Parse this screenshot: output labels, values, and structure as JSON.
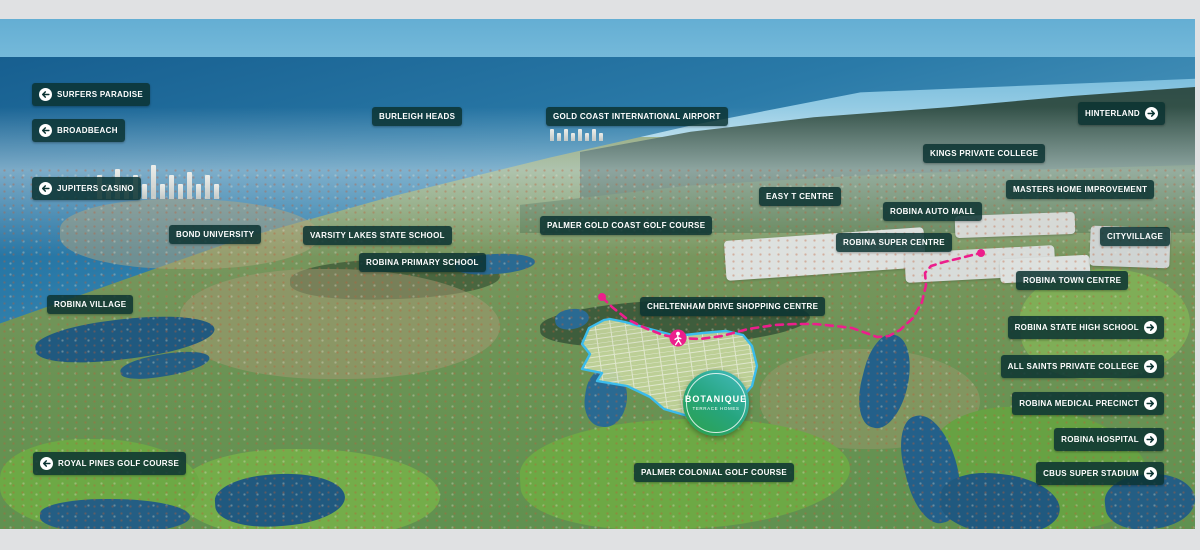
{
  "meta": {
    "title": "Botanique Robina aerial location map"
  },
  "colors": {
    "label_background": "#0a3231",
    "label_text": "#ffffff",
    "route_pink": "#ec1e8c",
    "boundary_cyan": "#3bbcec",
    "logo_gradient_start": "#46bcc2",
    "logo_gradient_end": "#2da148",
    "frame_grey": "#e0e1e3"
  },
  "logo": {
    "name": "BOTANIQUE",
    "tagline": "TERRACE HOMES"
  },
  "labels": [
    {
      "id": "surfers-paradise",
      "text": "SURFERS PARADISE",
      "x": 32,
      "y": 83,
      "arrow": "left"
    },
    {
      "id": "broadbeach",
      "text": "BROADBEACH",
      "x": 32,
      "y": 119,
      "arrow": "left"
    },
    {
      "id": "jupiters-casino",
      "text": "JUPITERS CASINO",
      "x": 32,
      "y": 177,
      "arrow": "left"
    },
    {
      "id": "burleigh-heads",
      "text": "BURLEIGH HEADS",
      "x": 372,
      "y": 107,
      "arrow": null
    },
    {
      "id": "gold-coast-international-airport",
      "text": "GOLD COAST INTERNATIONAL AIRPORT",
      "x": 546,
      "y": 107,
      "arrow": null
    },
    {
      "id": "hinterland",
      "text": "HINTERLAND",
      "right": 35,
      "y": 102,
      "arrow": "right"
    },
    {
      "id": "kings-private-college",
      "text": "KINGS PRIVATE COLLEGE",
      "x": 923,
      "y": 144,
      "arrow": null
    },
    {
      "id": "masters-home-improvement",
      "text": "MASTERS HOME IMPROVEMENT",
      "x": 1006,
      "y": 180,
      "arrow": null
    },
    {
      "id": "easy-t-centre",
      "text": "EASY T CENTRE",
      "x": 759,
      "y": 187,
      "arrow": null
    },
    {
      "id": "robina-auto-mall",
      "text": "ROBINA AUTO MALL",
      "x": 883,
      "y": 202,
      "arrow": null
    },
    {
      "id": "palmer-gold-coast-golf-course",
      "text": "PALMER GOLD COAST GOLF COURSE",
      "x": 540,
      "y": 216,
      "arrow": null
    },
    {
      "id": "bond-university",
      "text": "BOND UNIVERSITY",
      "x": 169,
      "y": 225,
      "arrow": null
    },
    {
      "id": "varsity-lakes-state-school",
      "text": "VARSITY LAKES STATE SCHOOL",
      "x": 303,
      "y": 226,
      "arrow": null
    },
    {
      "id": "cityvillage",
      "text": "CITYVILLAGE",
      "x": 1100,
      "y": 227,
      "arrow": null
    },
    {
      "id": "robina-super-centre",
      "text": "ROBINA SUPER CENTRE",
      "x": 836,
      "y": 233,
      "arrow": null
    },
    {
      "id": "robina-primary-school",
      "text": "ROBINA PRIMARY SCHOOL",
      "x": 359,
      "y": 253,
      "arrow": null
    },
    {
      "id": "robina-town-centre",
      "text": "ROBINA TOWN CENTRE",
      "x": 1016,
      "y": 271,
      "arrow": null
    },
    {
      "id": "robina-village",
      "text": "ROBINA VILLAGE",
      "x": 47,
      "y": 295,
      "arrow": null
    },
    {
      "id": "cheltenham-drive-shopping-centre",
      "text": "CHELTENHAM DRIVE SHOPPING CENTRE",
      "x": 640,
      "y": 297,
      "arrow": null
    },
    {
      "id": "robina-state-high-school",
      "text": "ROBINA STATE HIGH SCHOOL",
      "right": 36,
      "y": 316,
      "arrow": "right"
    },
    {
      "id": "all-saints-private-college",
      "text": "ALL SAINTS PRIVATE COLLEGE",
      "right": 36,
      "y": 355,
      "arrow": "right"
    },
    {
      "id": "robina-medical-precinct",
      "text": "ROBINA MEDICAL PRECINCT",
      "right": 36,
      "y": 392,
      "arrow": "right"
    },
    {
      "id": "robina-hospital",
      "text": "ROBINA HOSPITAL",
      "right": 36,
      "y": 428,
      "arrow": "right"
    },
    {
      "id": "cbus-super-stadium",
      "text": "CBUS SUPER STADIUM",
      "right": 36,
      "y": 462,
      "arrow": "right"
    },
    {
      "id": "royal-pines-golf-course",
      "text": "ROYAL PINES GOLF COURSE",
      "x": 33,
      "y": 452,
      "arrow": "left"
    },
    {
      "id": "palmer-colonial-golf-course",
      "text": "PALMER COLONIAL GOLF COURSE",
      "x": 634,
      "y": 463,
      "arrow": null
    }
  ],
  "map": {
    "site_boundary": {
      "points": [
        [
          604,
          320
        ],
        [
          589,
          328
        ],
        [
          582,
          344
        ],
        [
          590,
          354
        ],
        [
          582,
          369
        ],
        [
          602,
          373
        ],
        [
          597,
          381
        ],
        [
          627,
          386
        ],
        [
          650,
          397
        ],
        [
          664,
          409
        ],
        [
          688,
          416
        ],
        [
          716,
          413
        ],
        [
          739,
          401
        ],
        [
          752,
          386
        ],
        [
          757,
          366
        ],
        [
          752,
          346
        ],
        [
          743,
          335
        ],
        [
          726,
          331
        ],
        [
          703,
          333
        ],
        [
          676,
          336
        ],
        [
          650,
          329
        ],
        [
          625,
          322
        ],
        [
          610,
          319
        ]
      ]
    },
    "walking_route": {
      "style": "dashed",
      "points": [
        [
          602,
          297
        ],
        [
          612,
          307
        ],
        [
          627,
          319
        ],
        [
          645,
          328
        ],
        [
          663,
          335
        ],
        [
          678,
          338
        ],
        [
          700,
          339
        ],
        [
          722,
          336
        ],
        [
          748,
          329
        ],
        [
          775,
          325
        ],
        [
          795,
          324
        ],
        [
          815,
          324
        ],
        [
          835,
          326
        ],
        [
          852,
          328
        ],
        [
          866,
          333
        ],
        [
          877,
          337
        ],
        [
          889,
          336
        ],
        [
          900,
          330
        ],
        [
          913,
          318
        ],
        [
          922,
          302
        ],
        [
          926,
          285
        ],
        [
          925,
          273
        ],
        [
          931,
          266
        ],
        [
          944,
          262
        ],
        [
          961,
          258
        ],
        [
          976,
          254
        ],
        [
          981,
          253
        ]
      ],
      "endpoints": [
        [
          602,
          297
        ],
        [
          981,
          253
        ]
      ],
      "walker": {
        "x": 678,
        "y": 338
      }
    }
  }
}
